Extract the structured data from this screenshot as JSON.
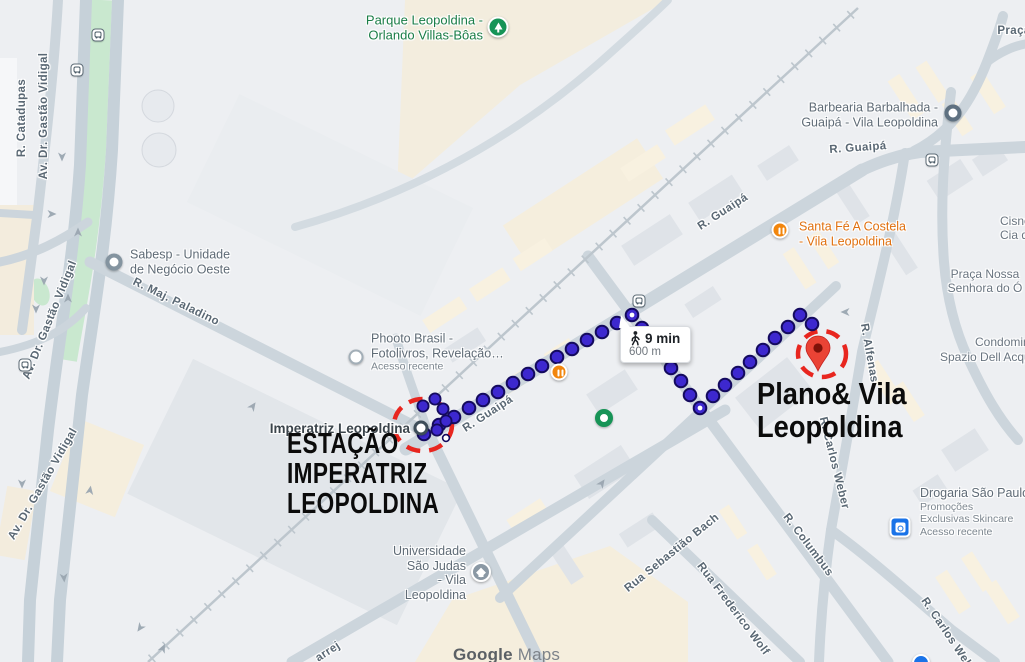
{
  "map_attribution": {
    "bold": "Google",
    "light": "Maps"
  },
  "tooltip": {
    "duration": "9 min",
    "distance": "600 m",
    "mode_icon": "walking-icon"
  },
  "annotations": {
    "origin": {
      "line1": "ESTAÇÃO",
      "line2": "IMPERATRIZ",
      "line3": "LEOPOLDINA"
    },
    "destination": {
      "line1": "Plano& Vila",
      "line2": "Leopoldina"
    }
  },
  "route": {
    "color": "#3d28cf",
    "outline": "#140a5e",
    "highlight": "#e8261f",
    "dots": [
      [
        424,
        434
      ],
      [
        439,
        425
      ],
      [
        454,
        417
      ],
      [
        469,
        408
      ],
      [
        483,
        400
      ],
      [
        498,
        392
      ],
      [
        513,
        383
      ],
      [
        528,
        374
      ],
      [
        542,
        366
      ],
      [
        557,
        357
      ],
      [
        572,
        349
      ],
      [
        587,
        340
      ],
      [
        602,
        332
      ],
      [
        617,
        323
      ],
      [
        632,
        315
      ],
      [
        642,
        328
      ],
      [
        651,
        341
      ],
      [
        661,
        355
      ],
      [
        671,
        368
      ],
      [
        681,
        381
      ],
      [
        690,
        395
      ],
      [
        700,
        408
      ],
      [
        713,
        396
      ],
      [
        725,
        385
      ],
      [
        738,
        373
      ],
      [
        750,
        362
      ],
      [
        763,
        350
      ],
      [
        775,
        338
      ],
      [
        788,
        327
      ],
      [
        800,
        315
      ],
      [
        812,
        324
      ]
    ],
    "cluster_dots": [
      [
        423,
        406
      ],
      [
        435,
        399
      ],
      [
        443,
        409
      ],
      [
        446,
        421
      ],
      [
        437,
        430
      ]
    ],
    "white_center_dots": [
      [
        632,
        315
      ],
      [
        700,
        408
      ]
    ],
    "small_white_dot": [
      446,
      438
    ],
    "pin": {
      "x": 818,
      "y": 348,
      "tip_y": 371
    },
    "origin_circle": {
      "cx": 423,
      "cy": 425,
      "rx": 29,
      "ry": 26
    },
    "destination_circle": {
      "cx": 822,
      "cy": 354,
      "rx": 24,
      "ry": 23
    }
  },
  "street_labels": [
    {
      "text": "R. Catadupas",
      "x": 22,
      "y": 118,
      "rot": -90
    },
    {
      "text": "Av. Dr. Gastão Vidigal",
      "x": 44,
      "y": 116,
      "rot": -90
    },
    {
      "text": "Av. Dr. Gastão Vidigal",
      "x": 50,
      "y": 320,
      "rot": -68
    },
    {
      "text": "Av. Dr. Gastão Vidigal",
      "x": 43,
      "y": 484,
      "rot": -60
    },
    {
      "text": "R. Maj. Paladino",
      "x": 176,
      "y": 302,
      "rot": 26
    },
    {
      "text": "R. Guaipá",
      "x": 488,
      "y": 414,
      "rot": -33
    },
    {
      "text": "R. Guaipá",
      "x": 723,
      "y": 212,
      "rot": -33
    },
    {
      "text": "R. Guaipá",
      "x": 858,
      "y": 148,
      "rot": -4
    },
    {
      "text": "R. Alfenas",
      "x": 869,
      "y": 353,
      "rot": 80
    },
    {
      "text": "R. Carlos Weber",
      "x": 834,
      "y": 463,
      "rot": 76
    },
    {
      "text": "R. Columbus",
      "x": 808,
      "y": 545,
      "rot": 53
    },
    {
      "text": "Rua Sebastião Bach",
      "x": 672,
      "y": 553,
      "rot": -39
    },
    {
      "text": "Rua Frederico Wolf",
      "x": 733,
      "y": 609,
      "rot": 53
    },
    {
      "text": "R. Carlos Weber",
      "x": 950,
      "y": 638,
      "rot": 56
    },
    {
      "text": "arrej",
      "x": 328,
      "y": 652,
      "rot": -33
    },
    {
      "text": "Praça",
      "x": 1014,
      "y": 31,
      "rot": 0
    }
  ],
  "area_labels": [
    {
      "lines": [
        "Praça Nossa",
        "Senhora do Ó"
      ],
      "x": 985,
      "y": 281,
      "align": "center"
    },
    {
      "lines": [
        "Cisne",
        "Cia de"
      ],
      "x": 1000,
      "y": 228,
      "align": "left"
    },
    {
      "lines": [
        "Condomini"
      ],
      "x": 975,
      "y": 342,
      "align": "left"
    },
    {
      "lines": [
        "Spazio Dell Acqua"
      ],
      "x": 940,
      "y": 357,
      "align": "left"
    }
  ],
  "poi_labels": [
    {
      "id": "parque-leopoldina",
      "icon": "park",
      "color": "green",
      "align": "right",
      "x": 483,
      "y": 28,
      "icon_x": 498,
      "icon_y": 27,
      "lines": [
        "Parque Leopoldina -",
        "Orlando Villas-Bôas"
      ]
    },
    {
      "id": "sabesp",
      "icon": "donut-gray",
      "align": "left",
      "x": 130,
      "y": 262,
      "icon_x": 114,
      "icon_y": 262,
      "lines": [
        "Sabesp - Unidade",
        "de Negócio Oeste"
      ]
    },
    {
      "id": "phooto-brasil",
      "icon": "donut-light",
      "align": "left",
      "x": 371,
      "y": 352,
      "icon_x": 356,
      "icon_y": 357,
      "lines": [
        "Phooto Brasil -",
        "Fotolivros, Revelação…"
      ],
      "sub": [
        "Acesso recente"
      ]
    },
    {
      "id": "barbearia-barbalhada",
      "icon": "donut-dark",
      "align": "right",
      "x": 938,
      "y": 115,
      "icon_x": 953,
      "icon_y": 113,
      "lines": [
        "Barbearia Barbalhada -",
        "Guaipá - Vila Leopoldina"
      ]
    },
    {
      "id": "santa-fe-a-costela",
      "icon": "restaurant",
      "color": "orange",
      "align": "left",
      "x": 799,
      "y": 234,
      "icon_x": 780,
      "icon_y": 230,
      "lines": [
        "Santa Fé A Costela",
        "- Vila Leopoldina"
      ]
    },
    {
      "id": "imperatriz-leopoldina-station",
      "icon": "station",
      "color": "dark",
      "align": "right",
      "x": 410,
      "y": 429,
      "icon_x": 421,
      "icon_y": 428,
      "lines": [
        "Imperatriz Leopoldina"
      ]
    },
    {
      "id": "universidade-sao-judas",
      "icon": "grad",
      "align": "right",
      "x": 466,
      "y": 573,
      "icon_x": 481,
      "icon_y": 572,
      "lines": [
        "Universidade",
        "São Judas",
        "- Vila",
        "Leopoldina"
      ]
    },
    {
      "id": "drogaria-sao-paulo",
      "icon": "pharmacy",
      "align": "left",
      "x": 920,
      "y": 512,
      "icon_x": 900,
      "icon_y": 527,
      "lines": [
        "Drogaria São Paulo"
      ],
      "sub": [
        "Promoções",
        "Exclusivas Skincare",
        "Acesso recente"
      ]
    }
  ],
  "standalone_icons": [
    {
      "type": "restaurant",
      "x": 559,
      "y": 372
    },
    {
      "type": "park-dot",
      "x": 604,
      "y": 418
    },
    {
      "type": "transit",
      "x": 98,
      "y": 35
    },
    {
      "type": "transit",
      "x": 77,
      "y": 70
    },
    {
      "type": "transit",
      "x": 25,
      "y": 365
    },
    {
      "type": "transit",
      "x": 639,
      "y": 301
    },
    {
      "type": "transit",
      "x": 932,
      "y": 160
    },
    {
      "type": "store-blue",
      "x": 921,
      "y": 663
    }
  ]
}
